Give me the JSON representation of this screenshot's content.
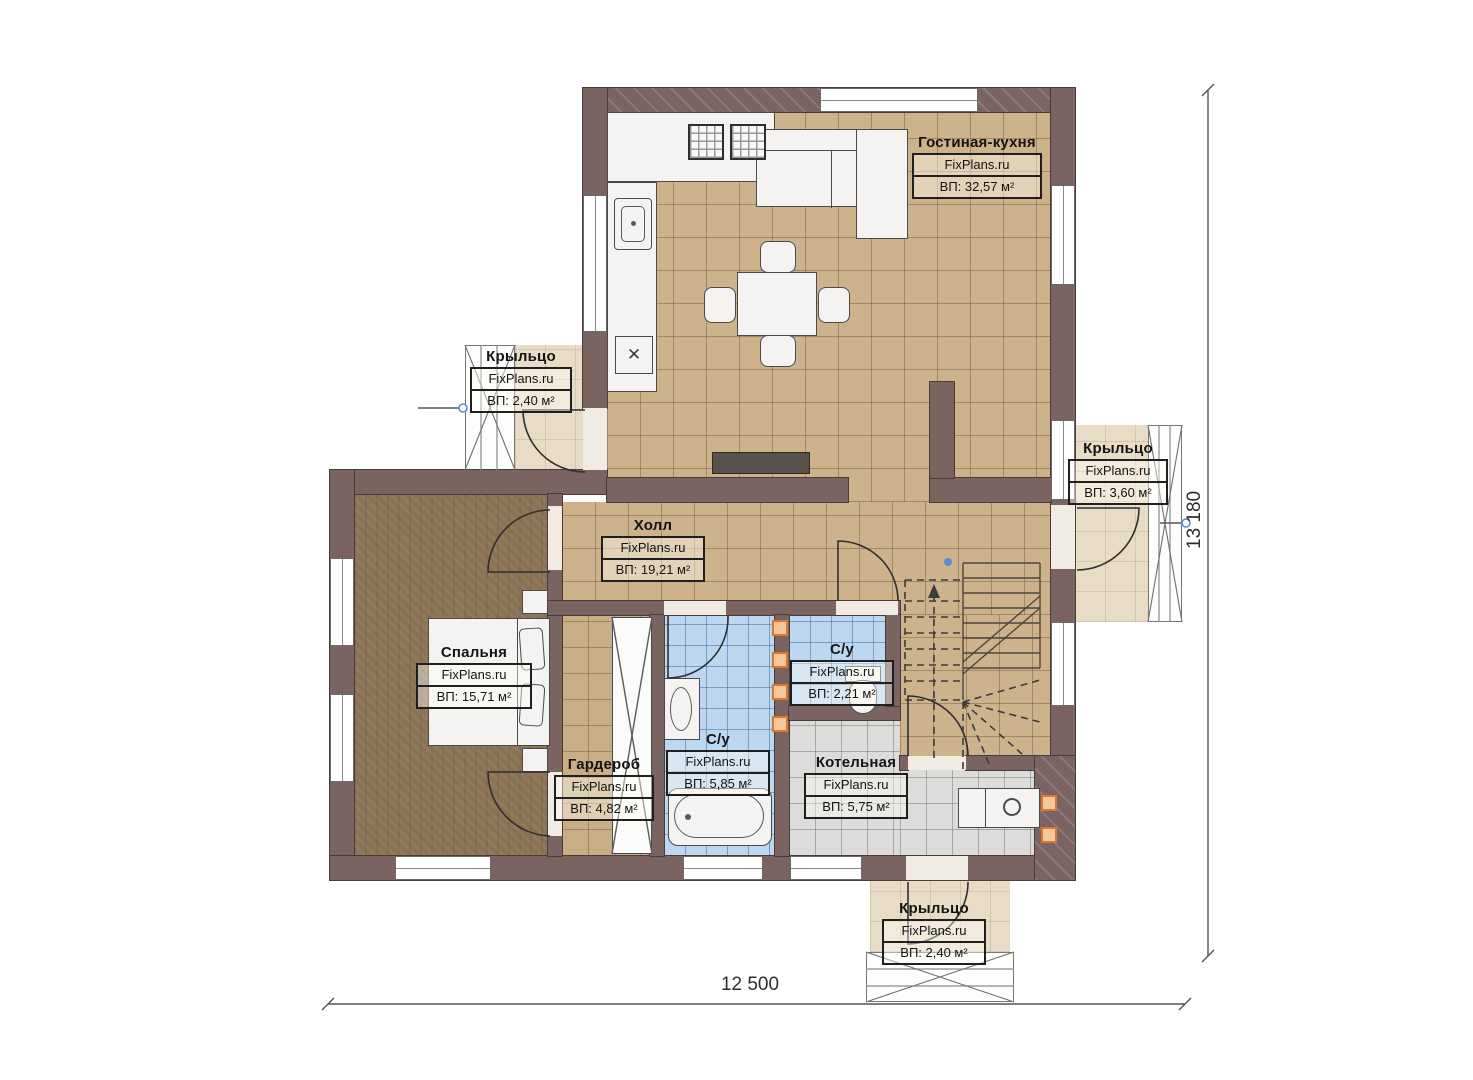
{
  "plan": {
    "watermark": "FixPlans.ru",
    "rooms": [
      {
        "id": "living-kitchen",
        "name": "Гостиная-кухня",
        "area": "ВП: 32,57 м²"
      },
      {
        "id": "porch-left",
        "name": "Крыльцо",
        "area": "ВП: 2,40 м²"
      },
      {
        "id": "porch-right",
        "name": "Крыльцо",
        "area": "ВП: 3,60 м²"
      },
      {
        "id": "porch-bottom",
        "name": "Крыльцо",
        "area": "ВП: 2,40 м²"
      },
      {
        "id": "hall",
        "name": "Холл",
        "area": "ВП: 19,21 м²"
      },
      {
        "id": "bedroom",
        "name": "Спальня",
        "area": "ВП: 15,71 м²"
      },
      {
        "id": "wardrobe",
        "name": "Гардероб",
        "area": "ВП: 4,82 м²"
      },
      {
        "id": "bathroom",
        "name": "С/у",
        "area": "ВП: 5,85 м²"
      },
      {
        "id": "wc",
        "name": "С/у",
        "area": "ВП: 2,21 м²"
      },
      {
        "id": "boiler-room",
        "name": "Котельная",
        "area": "ВП: 5,75 м²"
      }
    ],
    "dimensions": {
      "width": "12 500",
      "height": "13 180"
    },
    "symbols": {
      "cross": "✕"
    },
    "colors": {
      "wall": "#7a6462",
      "floor_tile": "#cdb38c",
      "floor_wood": "#8a7354",
      "tile_blue": "#bdd7f0",
      "tile_gray": "#dcdcda",
      "porch": "#e9dcc6",
      "marker_orange": "#e0762e",
      "node_blue": "#5b8bd0"
    }
  }
}
